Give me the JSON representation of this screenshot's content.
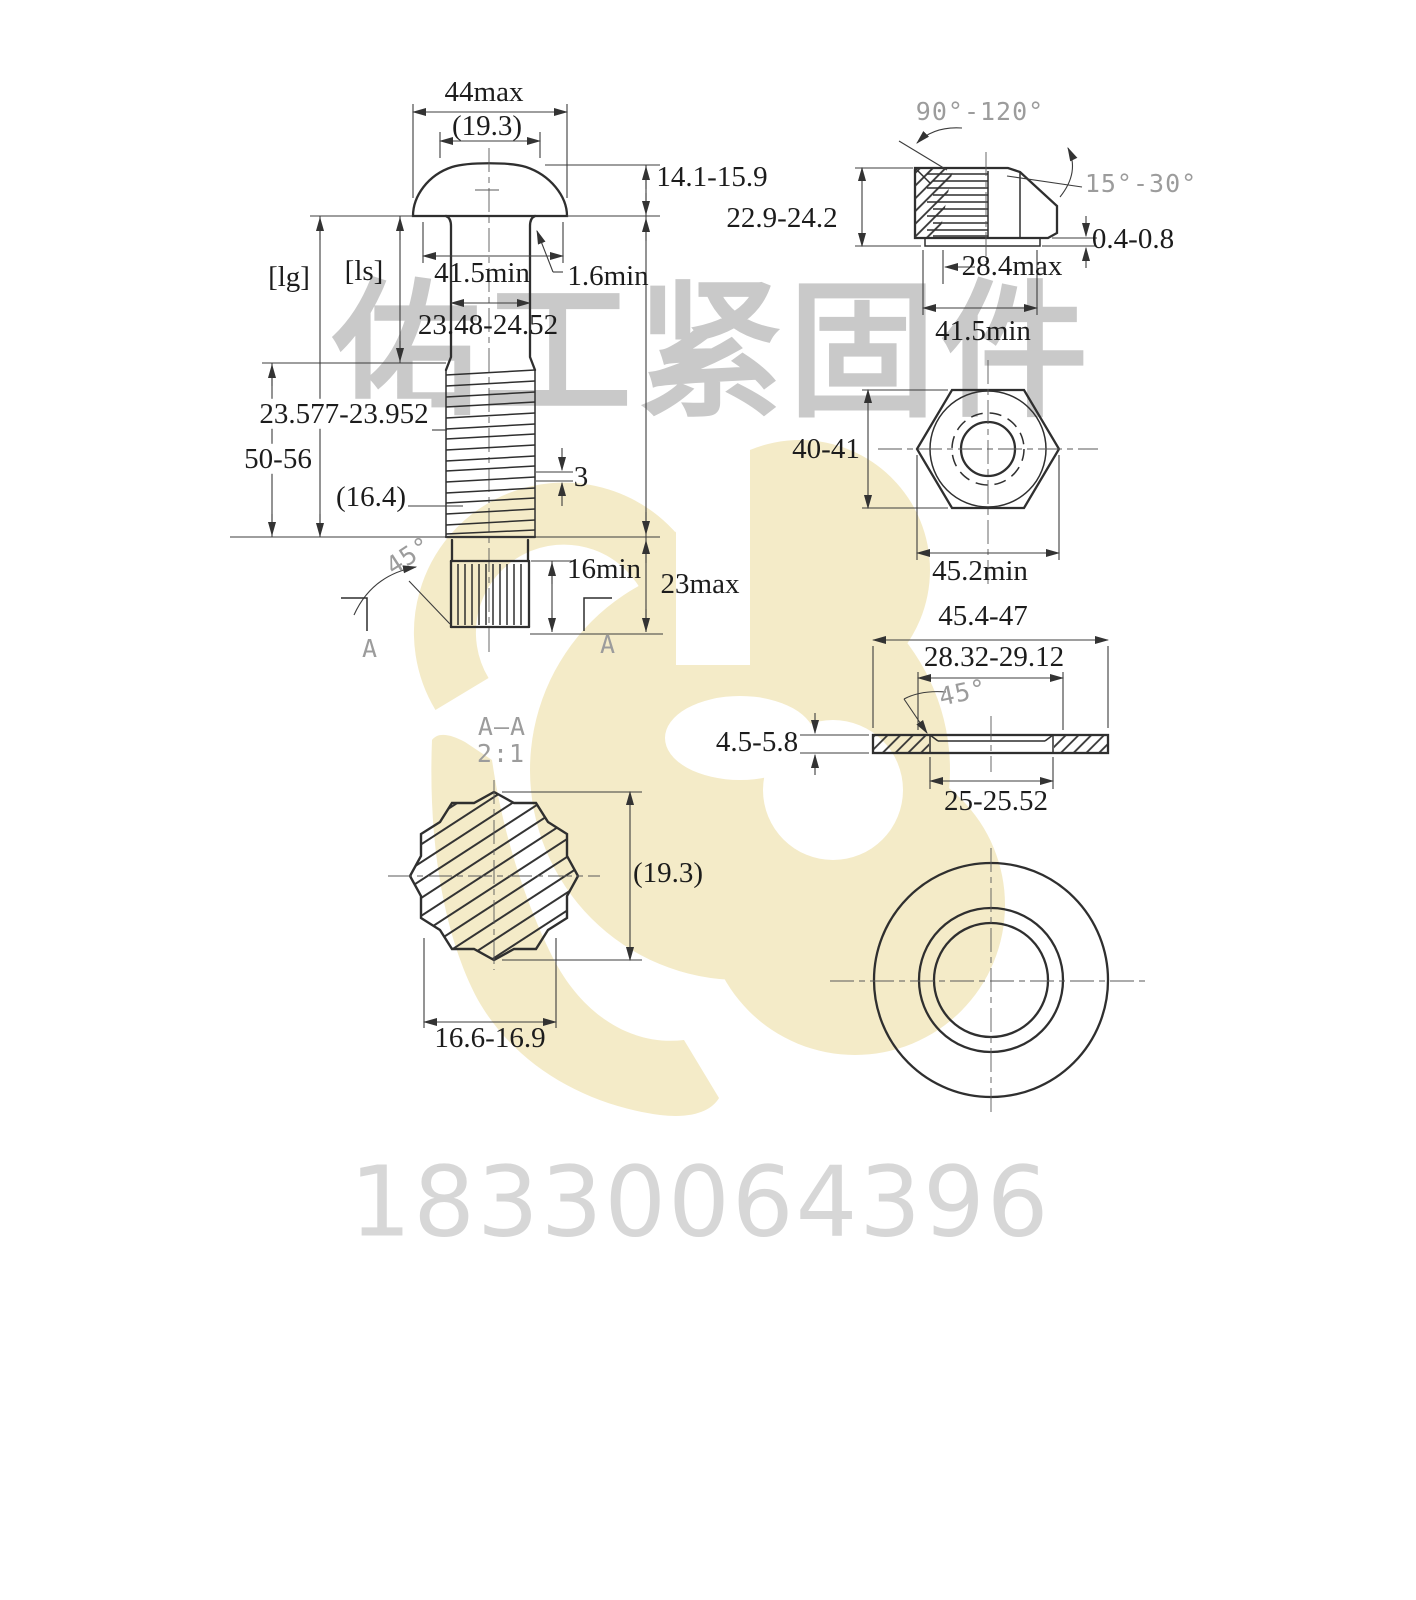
{
  "watermark": {
    "company_name": "佑工紧固件",
    "phone": "18330064396",
    "logo_yellow": "#f4ebc8",
    "text_gray": "#c9c9c9"
  },
  "bolt_front_view": {
    "head_width": "44max",
    "head_ref_dia": "(19.3)",
    "head_height": "14.1-15.9",
    "grip_length_label": "[lg]",
    "shank_length_label": "[ls]",
    "bearing_dia": "41.5min",
    "fillet_radius": "1.6min",
    "shank_dia": "23.48-24.52",
    "thread_dia": "23.577-23.952",
    "thread_length": "50-56",
    "spline_ref": "(16.4)",
    "thread_pitch": "3",
    "chamfer_angle": "45°",
    "spline_length": "16min",
    "end_length": "23max",
    "section_mark": "A"
  },
  "nut_section_view": {
    "countersink_angle": "90°-120°",
    "cone_angle": "15°-30°",
    "nut_height": "22.9-24.2",
    "washer_face_height": "0.4-0.8",
    "washer_face_dia": "28.4max",
    "bearing_dia": "41.5min"
  },
  "nut_top_view": {
    "across_flats": "40-41",
    "across_corners": "45.2min"
  },
  "washer_section_view": {
    "outer_dia": "45.4-47",
    "chamfer_dia": "28.32-29.12",
    "chamfer_angle": "45°",
    "thickness": "4.5-5.8",
    "hole_dia": "25-25.52"
  },
  "bolt_section_view": {
    "view_label": "A—A",
    "scale_label": "2:1",
    "ref_dia": "(19.3)",
    "across_flats": "16.6-16.9"
  }
}
